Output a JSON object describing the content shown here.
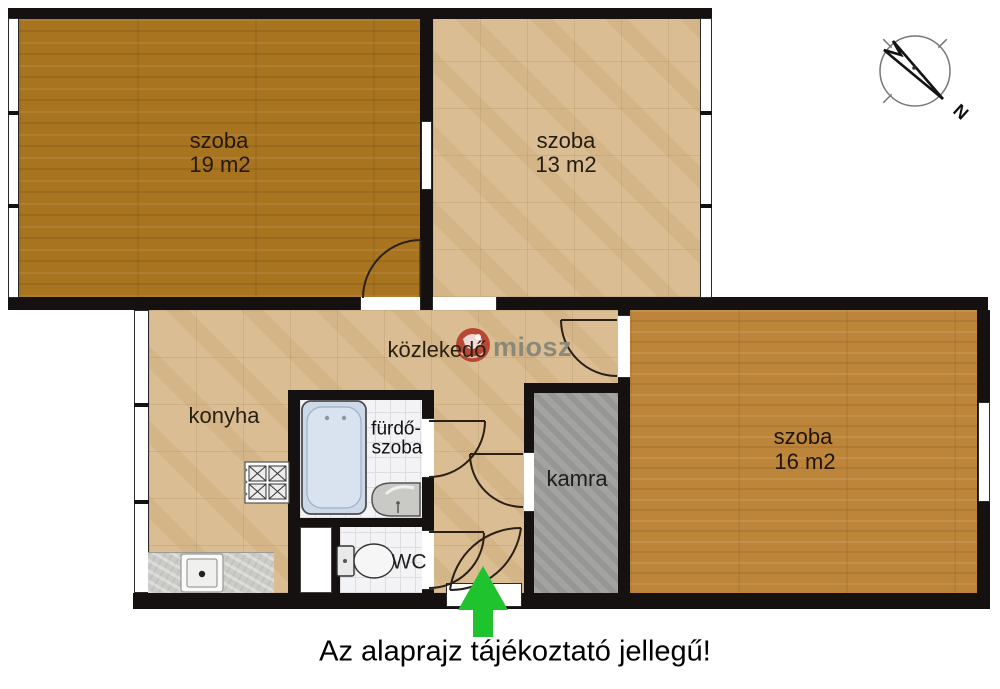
{
  "caption": "Az alaprajz tájékoztató jellegű!",
  "watermark": {
    "brand": "miosz"
  },
  "compass": {
    "north_label": "N"
  },
  "rooms": {
    "szoba19": {
      "name": "szoba",
      "area": "19 m2"
    },
    "szoba13": {
      "name": "szoba",
      "area": "13 m2"
    },
    "szoba16": {
      "name": "szoba",
      "area": "16 m2"
    },
    "konyha": {
      "name": "konyha"
    },
    "kozlekedo": {
      "name": "közlekedő"
    },
    "furdoszoba": {
      "name_line1": "fürdő-",
      "name_line2": "szoba"
    },
    "kamra": {
      "name": "kamra"
    },
    "wc": {
      "name": "WC"
    }
  },
  "colors": {
    "wall": "#141110",
    "wood_dark": "#a97420",
    "wood_light": "#bd8539",
    "tile_tan": "#dabd92",
    "pantry_gray": "#9e9e9c",
    "arrow_green": "#1fc32e",
    "watermark_red": "#b43a2c",
    "watermark_text": "#8b887a"
  }
}
